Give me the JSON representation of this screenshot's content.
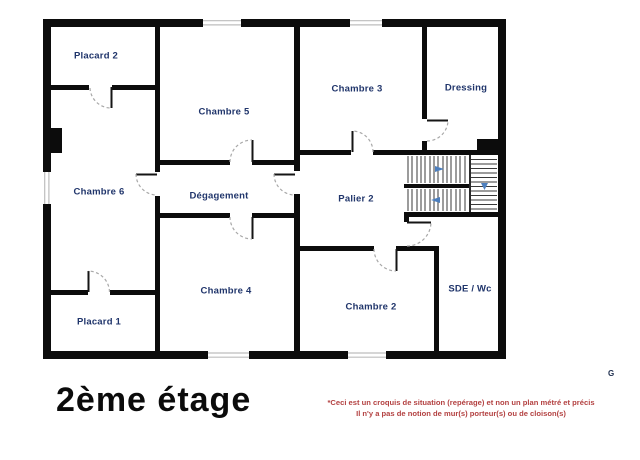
{
  "floor_plan": {
    "title": "2ème étage",
    "corner_mark": "G",
    "rooms": [
      {
        "id": "placard-2",
        "label": "Placard 2"
      },
      {
        "id": "chambre-5",
        "label": "Chambre 5"
      },
      {
        "id": "chambre-3",
        "label": "Chambre 3"
      },
      {
        "id": "dressing",
        "label": "Dressing"
      },
      {
        "id": "chambre-6",
        "label": "Chambre 6"
      },
      {
        "id": "degagement",
        "label": "Dégagement"
      },
      {
        "id": "palier-2",
        "label": "Palier 2"
      },
      {
        "id": "chambre-4",
        "label": "Chambre 4"
      },
      {
        "id": "chambre-2",
        "label": "Chambre 2"
      },
      {
        "id": "sde-wc",
        "label": "SDE / Wc"
      },
      {
        "id": "placard-1",
        "label": "Placard 1"
      }
    ],
    "disclaimer": {
      "line1": "*Ceci est un croquis de situation (repérage) et non un plan métré et précis",
      "line2": "Il n'y a pas de notion de mur(s) porteur(s) ou de cloison(s)"
    },
    "colors": {
      "wall": "#0c0c0c",
      "room_label": "#20356b",
      "disclaimer_text": "#b34141",
      "stair_arrow": "#4d7fbe"
    }
  }
}
